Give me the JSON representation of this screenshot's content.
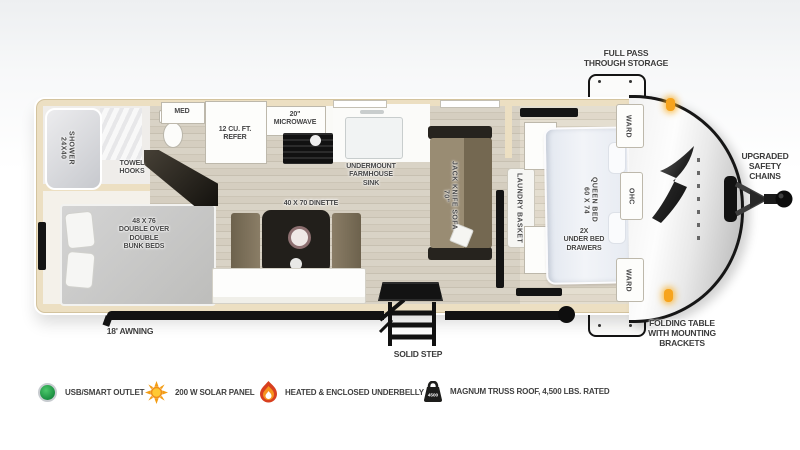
{
  "title": "Travel trailer floor plan",
  "plan": {
    "exterior": {
      "full_pass_storage": "FULL PASS\nTHROUGH STORAGE",
      "upgraded_chains": "UPGRADED\nSAFETY\nCHAINS",
      "folding_table": "FOLDING TABLE\nWITH MOUNTING\nBRACKETS",
      "awning": "18' AWNING",
      "solid_step": "SOLID STEP"
    },
    "bathroom": {
      "shower": "24X40\nSHOWER",
      "towel_hooks": "TOWEL\nHOOKS",
      "med": "MED"
    },
    "kitchen": {
      "refer": "12 CU. FT.\nREFER",
      "microwave": "20\"\nMICROWAVE",
      "sink": "UNDERMOUNT\nFARMHOUSE\nSINK",
      "dinette": "40 X 70 DINETTE"
    },
    "living": {
      "sofa": "70\"\nJACK KNIFE SOFA",
      "bunks": "48 X 76\nDOUBLE OVER\nDOUBLE\nBUNK BEDS"
    },
    "bedroom": {
      "laundry": "LAUNDRY BASKET",
      "queen_bed": "60 X 74\nQUEEN BED",
      "under_bed": "2X\nUNDER BED\nDRAWERS",
      "ward_top": "WARD",
      "ohc": "OHC",
      "ward_bottom": "WARD"
    }
  },
  "legend": {
    "items": [
      {
        "icon": "usb-smart-outlet-icon",
        "label": "USB/SMART OUTLET",
        "color": "#1f9a44"
      },
      {
        "icon": "solar-panel-icon",
        "label": "200 W SOLAR PANEL",
        "color": "#f59b1e"
      },
      {
        "icon": "heated-underbelly-icon",
        "label": "HEATED & ENCLOSED UNDERBELLY",
        "color": "#d64123"
      },
      {
        "icon": "truss-roof-icon",
        "label": "MAGNUM TRUSS ROOF, 4,500 LBS. RATED",
        "color": "#1d1d1b",
        "badge": "4500"
      }
    ]
  },
  "colors": {
    "wall_tan": "#ecdfc2",
    "floor_wood": "#d6cfc2",
    "furniture_olive": "#8a7d66",
    "accent_amber": "#f7a41d",
    "label_gray": "#454545"
  }
}
